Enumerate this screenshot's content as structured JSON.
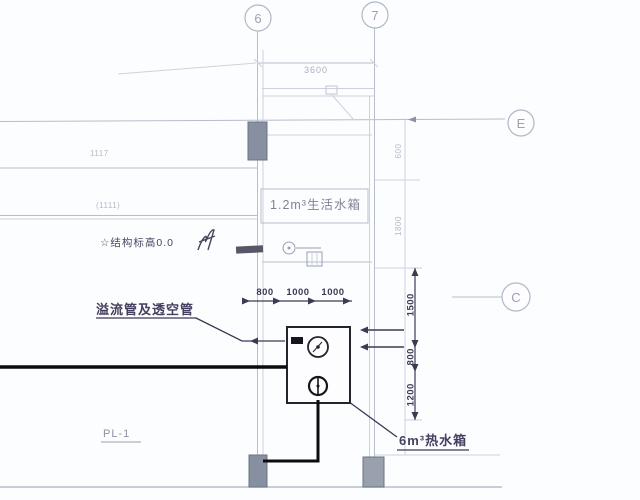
{
  "grid": {
    "top_left": "6",
    "top_right": "7",
    "right_upper": "E",
    "right_lower": "C"
  },
  "labels": {
    "living_tank": "1.2m³生活水箱",
    "overflow_vent_pipes": "溢流管及透空管",
    "elevation_note": "☆结构标高0.0",
    "hot_water_tank": "6m³热水箱",
    "riser": "PL-1",
    "faint_note_1": "1117",
    "faint_note_2": "(1111)"
  },
  "dimensions": {
    "top_span": "3600",
    "horizontal": [
      "800",
      "1000",
      "1000"
    ],
    "vertical": [
      "1500",
      "800",
      "1200"
    ],
    "faint_vertical": [
      "600",
      "1800"
    ]
  },
  "colors": {
    "background": "#fcfdff",
    "light_line": "#b6bdcb",
    "lighter_line": "#ccd2dd",
    "annotation": "#3e3954",
    "pipe_black": "#0b0b10",
    "column_fill": "#8790a0"
  }
}
